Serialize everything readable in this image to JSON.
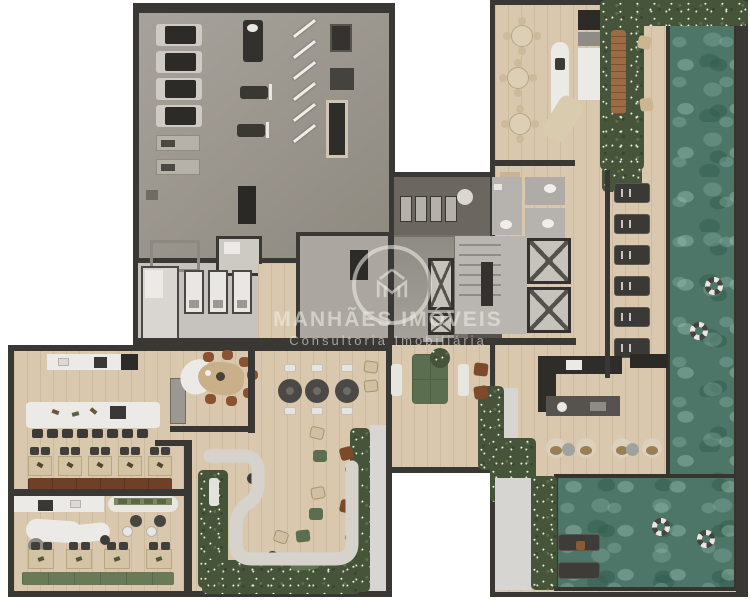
{
  "watermark": {
    "logo": "manhaes-house-monogram",
    "title": "MANHÃES IMÓVEIS",
    "subtitle": "Consultoria Imobiliária"
  },
  "palette": {
    "wall": "#3a3834",
    "wood": "#d9c8ae",
    "gym": "#9c968e",
    "core": "#74706a",
    "bath": "#c6c3be",
    "pool": "#4d7668",
    "green": "#46543a",
    "flower": "#edf0e4",
    "counter": "#eceae6",
    "dark": "#3c3a36",
    "brown": "#6f3f27",
    "sofa": "#5c6e50",
    "tan": "#d3c4a6",
    "teak": "#9c6b44",
    "concrete": "#d6d3cd",
    "wm": "rgba(238,236,230,0.58)"
  },
  "zones": {
    "gym": {
      "name": "fitness-room",
      "treadmills": 4,
      "rowing_machines": 2,
      "barbells": 6,
      "flat_benches": 2,
      "strength_machines": 3
    },
    "core": {
      "name": "service-core",
      "lockers": 4,
      "elevators": 4,
      "stairs": 1,
      "restrooms": 3,
      "shower_stalls": 4
    },
    "gourmet_lounge": {
      "name": "gourmet-lounge",
      "round_tables": 3,
      "chairs_per_table": 4
    },
    "pool": {
      "name": "pool",
      "life_rings": 4,
      "water_loungers": 2
    },
    "pool_deck": {
      "name": "pool-deck",
      "sun_loungers": 6,
      "shell_chairs": 4,
      "side_tables": 2
    },
    "dining_hall": {
      "name": "restaurant",
      "island_stools": 8,
      "tables_row_upper": 5,
      "tables_row_lower": 4,
      "chairs_per_table": 2
    },
    "private_dining": {
      "name": "private-dining",
      "chairs": 7
    },
    "center_lounge": {
      "name": "lobby-lounge",
      "round_tables": 3
    },
    "garden_lounge": {
      "name": "garden-lounge",
      "poufs": 6
    }
  }
}
